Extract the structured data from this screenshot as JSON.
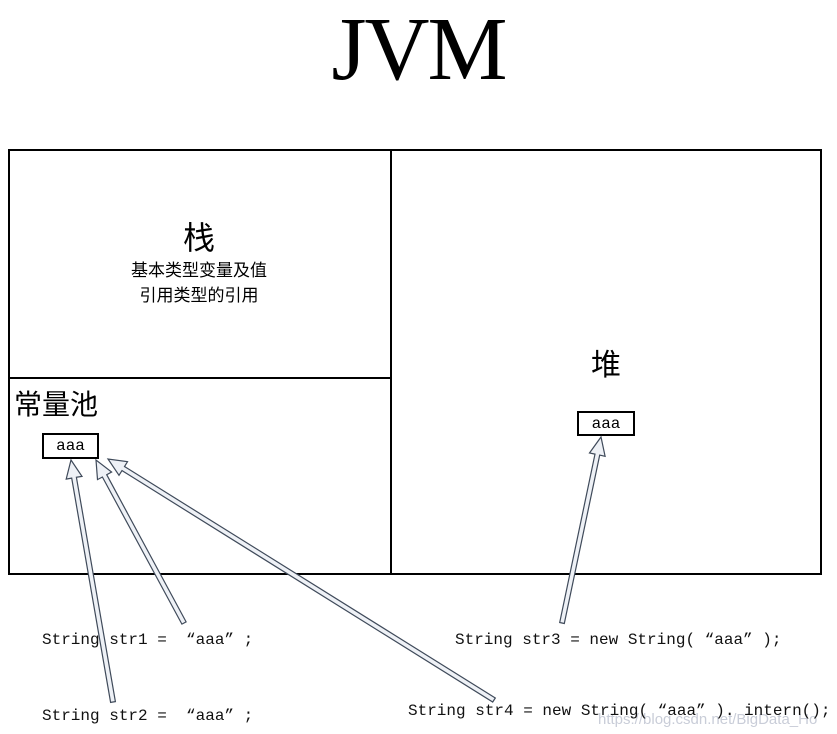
{
  "title": "JVM",
  "colors": {
    "border": "#000000",
    "arrow_fill": "#eef1f6",
    "arrow_stroke": "#3f4a5a",
    "watermark": "#c9cdd8"
  },
  "regions": {
    "stack": {
      "label": "栈",
      "line1": "基本类型变量及值",
      "line2": "引用类型的引用"
    },
    "constant_pool": {
      "label": "常量池",
      "value": "aaa"
    },
    "heap": {
      "label": "堆",
      "value": "aaa"
    }
  },
  "code": {
    "str1": "String str1 =  “aaa” ;",
    "str2": "String str2 =  “aaa” ;",
    "str3": "String str3 = new String( “aaa” );",
    "str4": "String str4 = new String( “aaa” ). intern();"
  },
  "watermark": "https://blog.csdn.net/BigData_Ho",
  "arrows": [
    {
      "name": "arrow-str1-to-pool",
      "from": [
        184,
        623
      ],
      "to": [
        96,
        460
      ]
    },
    {
      "name": "arrow-str2-to-pool",
      "from": [
        113,
        702
      ],
      "to": [
        71,
        460
      ]
    },
    {
      "name": "arrow-str3-to-heap",
      "from": [
        562,
        623
      ],
      "to": [
        601,
        437
      ]
    },
    {
      "name": "arrow-str4-to-pool",
      "from": [
        494,
        700
      ],
      "to": [
        108,
        459
      ]
    }
  ]
}
